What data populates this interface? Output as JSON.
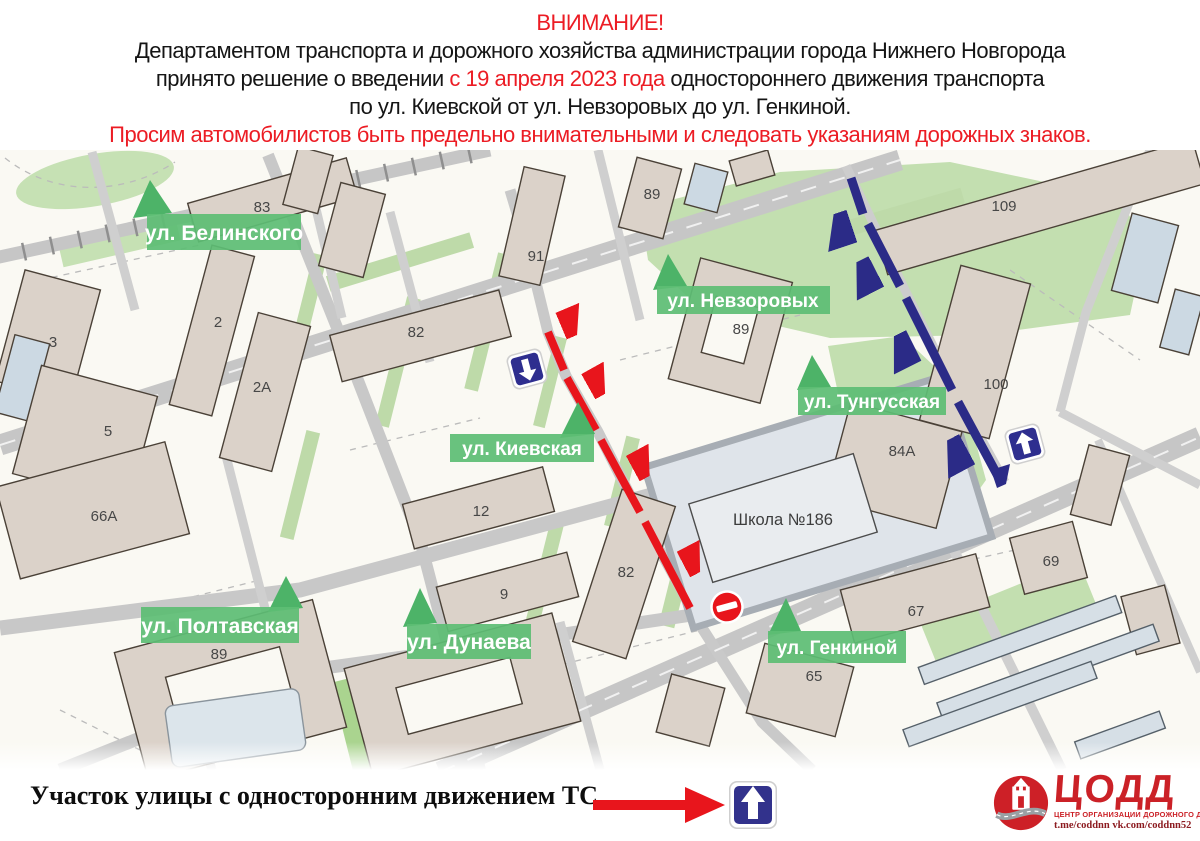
{
  "header": {
    "title": "ВНИМАНИЕ!",
    "line1": "Департаментом транспорта и дорожного хозяйства администрации города Нижнего Новгорода",
    "line2_pre": "принято решение о введении ",
    "line2_red": "с 19 апреля 2023 года",
    "line2_post": " одностороннего движения транспорта",
    "line3": "по ул. Киевской от ул. Невзоровых до ул. Генкиной.",
    "warning": "Просим автомобилистов быть предельно внимательными и следовать указаниям дорожных знаков."
  },
  "map": {
    "street_labels": [
      {
        "text": "ул. Белинского"
      },
      {
        "text": "ул. Невзоровых"
      },
      {
        "text": "ул. Киевская"
      },
      {
        "text": "ул. Тунгусская"
      },
      {
        "text": "ул. Полтавская"
      },
      {
        "text": "ул. Дунаева"
      },
      {
        "text": "ул. Генкиной"
      }
    ],
    "building_numbers": [
      {
        "label": "83"
      },
      {
        "label": "2"
      },
      {
        "label": "2А"
      },
      {
        "label": "3"
      },
      {
        "label": "5"
      },
      {
        "label": "66А"
      },
      {
        "label": "89"
      },
      {
        "label": "12"
      },
      {
        "label": "9"
      },
      {
        "label": "82"
      },
      {
        "label": "82"
      },
      {
        "label": "91"
      },
      {
        "label": "89"
      },
      {
        "label": "89"
      },
      {
        "label": "109"
      },
      {
        "label": "100"
      },
      {
        "label": "84А"
      },
      {
        "label": "69"
      },
      {
        "label": "67"
      },
      {
        "label": "65"
      },
      {
        "label": "Школа №186"
      }
    ],
    "icons": {
      "one_way_down_sign": "blue square, white arrow down",
      "one_way_up_sign": "blue square, white arrow up",
      "no_entry_sign": "red circle, white horizontal bar"
    },
    "routes": {
      "red_route": "one-way direction along ул. Киевская (south-bound)",
      "blue_route": "one-way direction along ул. Тунгусская (north-bound)"
    }
  },
  "legend": {
    "text": "Участок улицы с односторонним движением ТС",
    "icon": "one-way traffic sign"
  },
  "logo": {
    "name": "ЦОДД",
    "tagline": "ЦЕНТР ОРГАНИЗАЦИИ ДОРОЖНОГО ДВИЖЕНИЯ",
    "links": "t.me/coddnn vk.com/coddnn52"
  },
  "colors": {
    "accent_red": "#EC1C24",
    "route_red": "#E8151C",
    "route_blue": "#2B2B87",
    "label_green": "#5EBD74",
    "road_gray": "#C6C6C6",
    "building_beige": "#DBD2C9"
  }
}
